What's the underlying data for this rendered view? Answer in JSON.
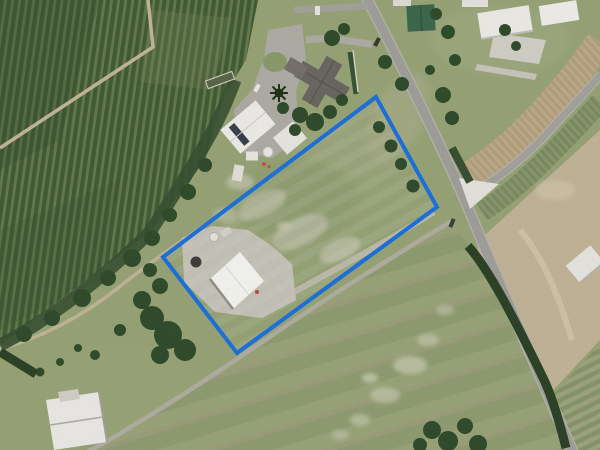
{
  "map": {
    "kind": "satellite-aerial-photo",
    "width": 600,
    "height": 450,
    "boundary": {
      "shape": "quadrilateral",
      "points_str": "376,97 437,207 237,353 163,257",
      "color": "#1d6fd6",
      "stroke_width": "4"
    },
    "features": [
      {
        "name": "orchard-block",
        "label": "orchard tree rows (north-west)"
      },
      {
        "name": "house-with-dark-roof",
        "label": "dwelling with driveway loop"
      },
      {
        "name": "solar-panel-shed",
        "label": "white shed with solar panels"
      },
      {
        "name": "main-white-shed",
        "label": "large white shed inside boundary"
      },
      {
        "name": "industrial-yard",
        "label": "concrete yard with tanks"
      },
      {
        "name": "main-road",
        "label": "sealed road running north-south"
      },
      {
        "name": "side-road",
        "label": "side road to north-east"
      },
      {
        "name": "farm-track",
        "label": "farm track along south-east boundary"
      },
      {
        "name": "barn",
        "label": "white barn (south-west)"
      },
      {
        "name": "green-roof-shed",
        "label": "green roofed shed (north)"
      },
      {
        "name": "bare-dirt-paddock",
        "label": "bare cultivated paddock (east)"
      },
      {
        "name": "shelterbelt",
        "label": "shelterbelt trees"
      }
    ]
  },
  "colors": {
    "boundary_blue": "#1d6fd6",
    "grass_base": "#9ca97b",
    "orchard_dark": "#44603a",
    "orchard_light": "#6b7d50",
    "road_gray": "#a6a5a0",
    "concrete": "#cbc8bd",
    "dirt_tan": "#c8ba9d",
    "roof_white": "#f5f4f0",
    "roof_dark": "#6f6b66",
    "roof_green": "#3f6c51",
    "tree_green": "#33502e"
  }
}
